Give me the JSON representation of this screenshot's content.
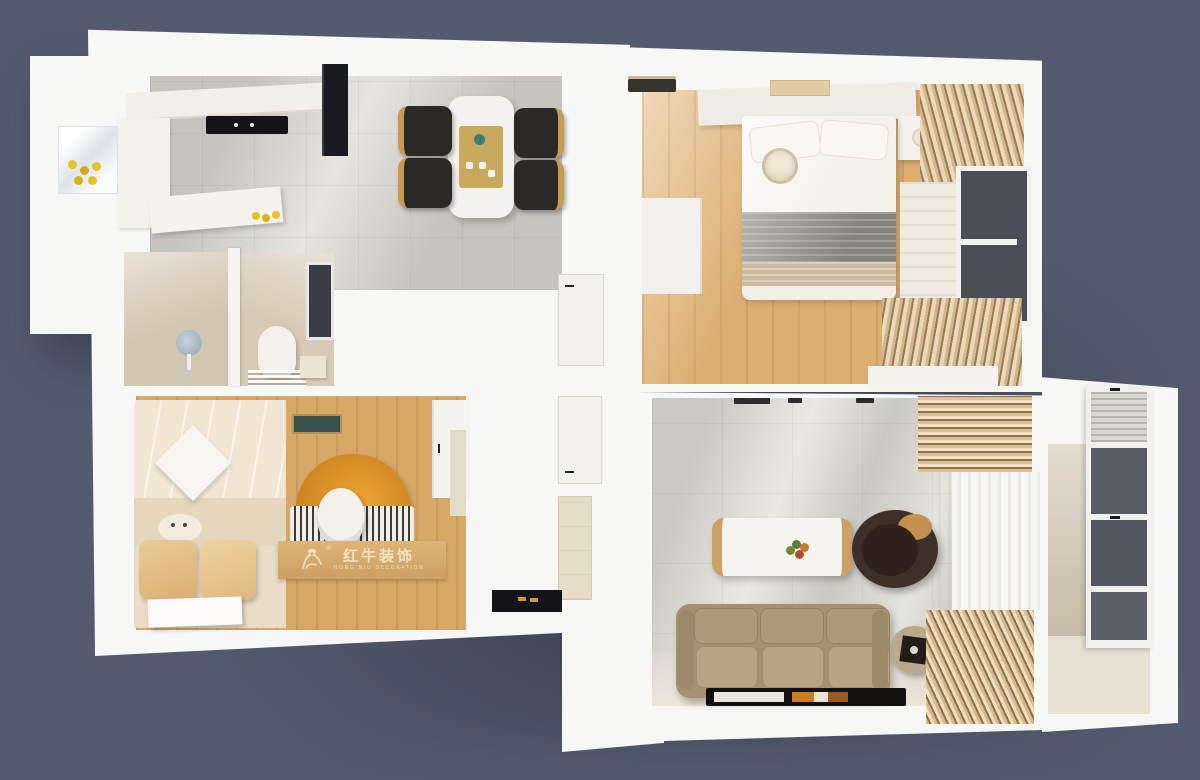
{
  "watermark": {
    "registered": "®",
    "title_cn": "红牛装饰",
    "subtitle_en": "HONG NIU DECORATION"
  },
  "palette": {
    "background": "#545b6e",
    "wall_white": "#f7f7f5",
    "tile_gray": "#c7c4c0",
    "wood_light": "#dcae72",
    "wood_medium": "#d7a766",
    "bath_beige": "#d2c5b2",
    "curtain_tan": "#c9a97e",
    "sofa_taupe": "#a39172",
    "armchair_brown": "#3e3026",
    "rug_orange": "#e2932c",
    "glass_dark": "#4a4e57",
    "doormat_black": "#141418",
    "lemon_yellow": "#e6c41e",
    "watermark_wood": "#d4ab6b",
    "watermark_text": "#efe3c2"
  },
  "rooms": [
    {
      "name": "kitchen",
      "floor": "gray-tile"
    },
    {
      "name": "dining-area",
      "floor": "gray-tile"
    },
    {
      "name": "master-bedroom",
      "floor": "light-wood"
    },
    {
      "name": "bathroom",
      "floor": "beige-stone"
    },
    {
      "name": "second-bedroom",
      "floor": "light-wood"
    },
    {
      "name": "hallway",
      "floor": "white"
    },
    {
      "name": "living-room",
      "floor": "gray-marble"
    },
    {
      "name": "balcony",
      "floor": "beige-tile"
    }
  ]
}
